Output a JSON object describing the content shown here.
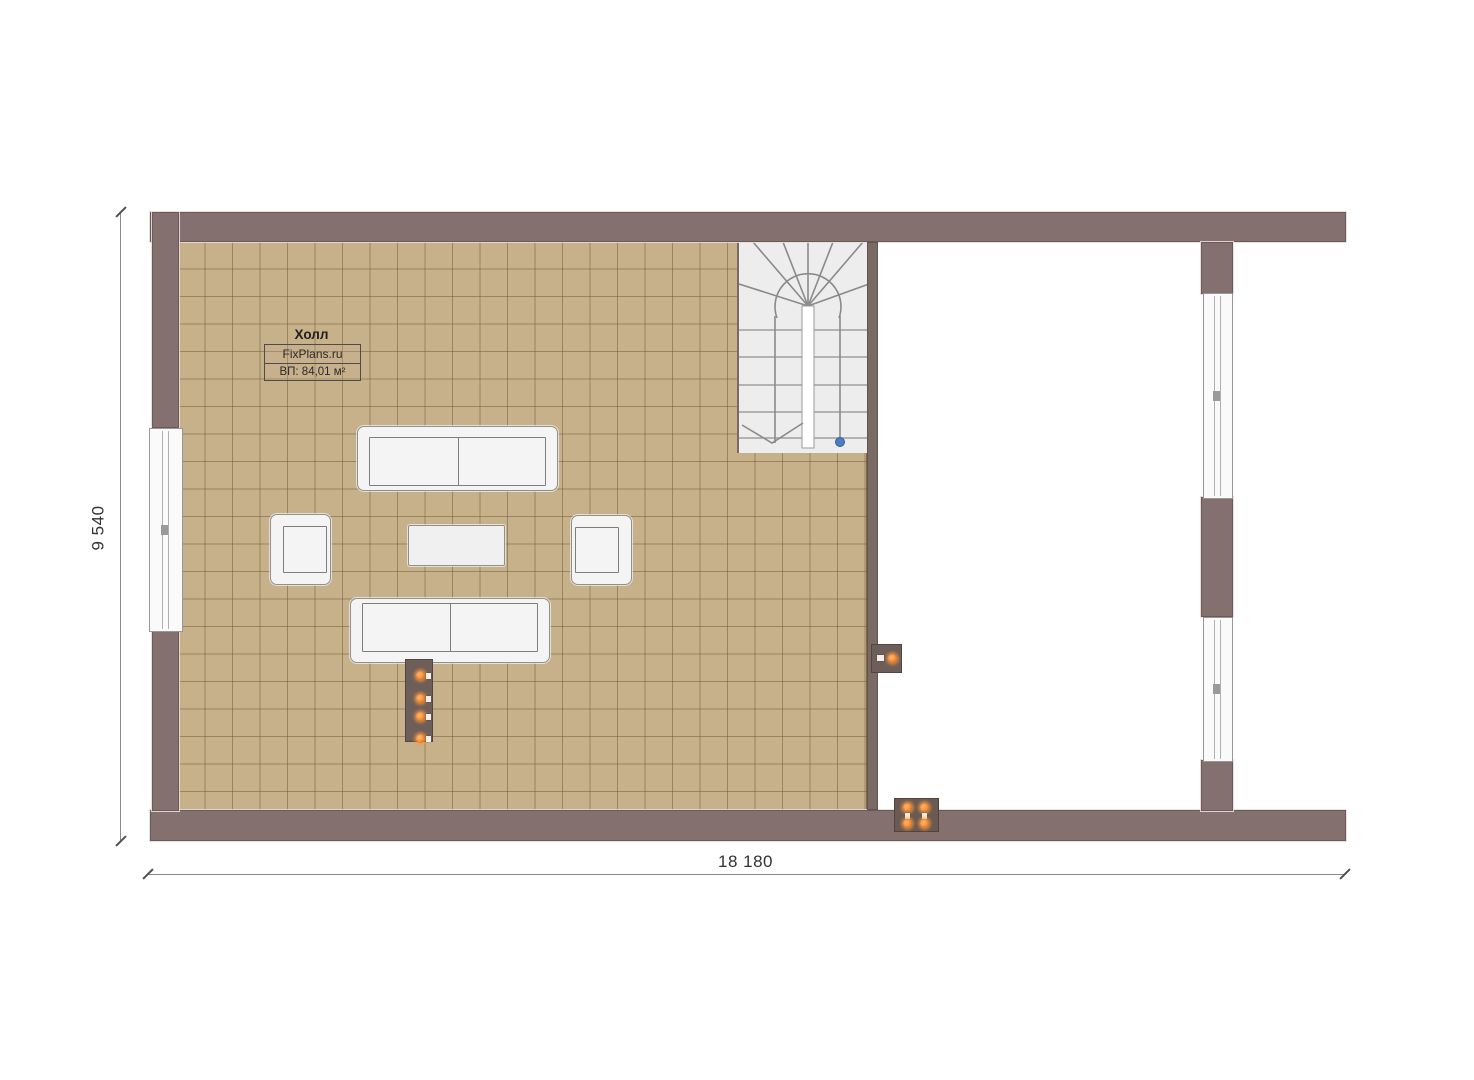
{
  "room": {
    "name": "Холл",
    "brand": "FixPlans.ru",
    "area_label": "ВП: 84,01 м²"
  },
  "dimensions": {
    "horizontal": "18 180",
    "vertical": "9 540"
  },
  "colors": {
    "wall": "#84706e",
    "interior_wall": "#796a63",
    "tile_floor": "#c7b18b",
    "tile_grid_line": "#8b7a5e",
    "stair_background": "#ededed",
    "furniture_fill": "#f4f4f4",
    "indicator_orange": "#e8781e",
    "marker_blue": "#4d7fc0",
    "dimension_text": "#333333"
  },
  "symbols": {
    "staircase": "u-shaped-staircase-with-winders",
    "utility_panel_indicators": 4,
    "wall_switch_indicators": 1,
    "floor_socket_indicators": 4,
    "stair_marker": "blue-circle"
  }
}
